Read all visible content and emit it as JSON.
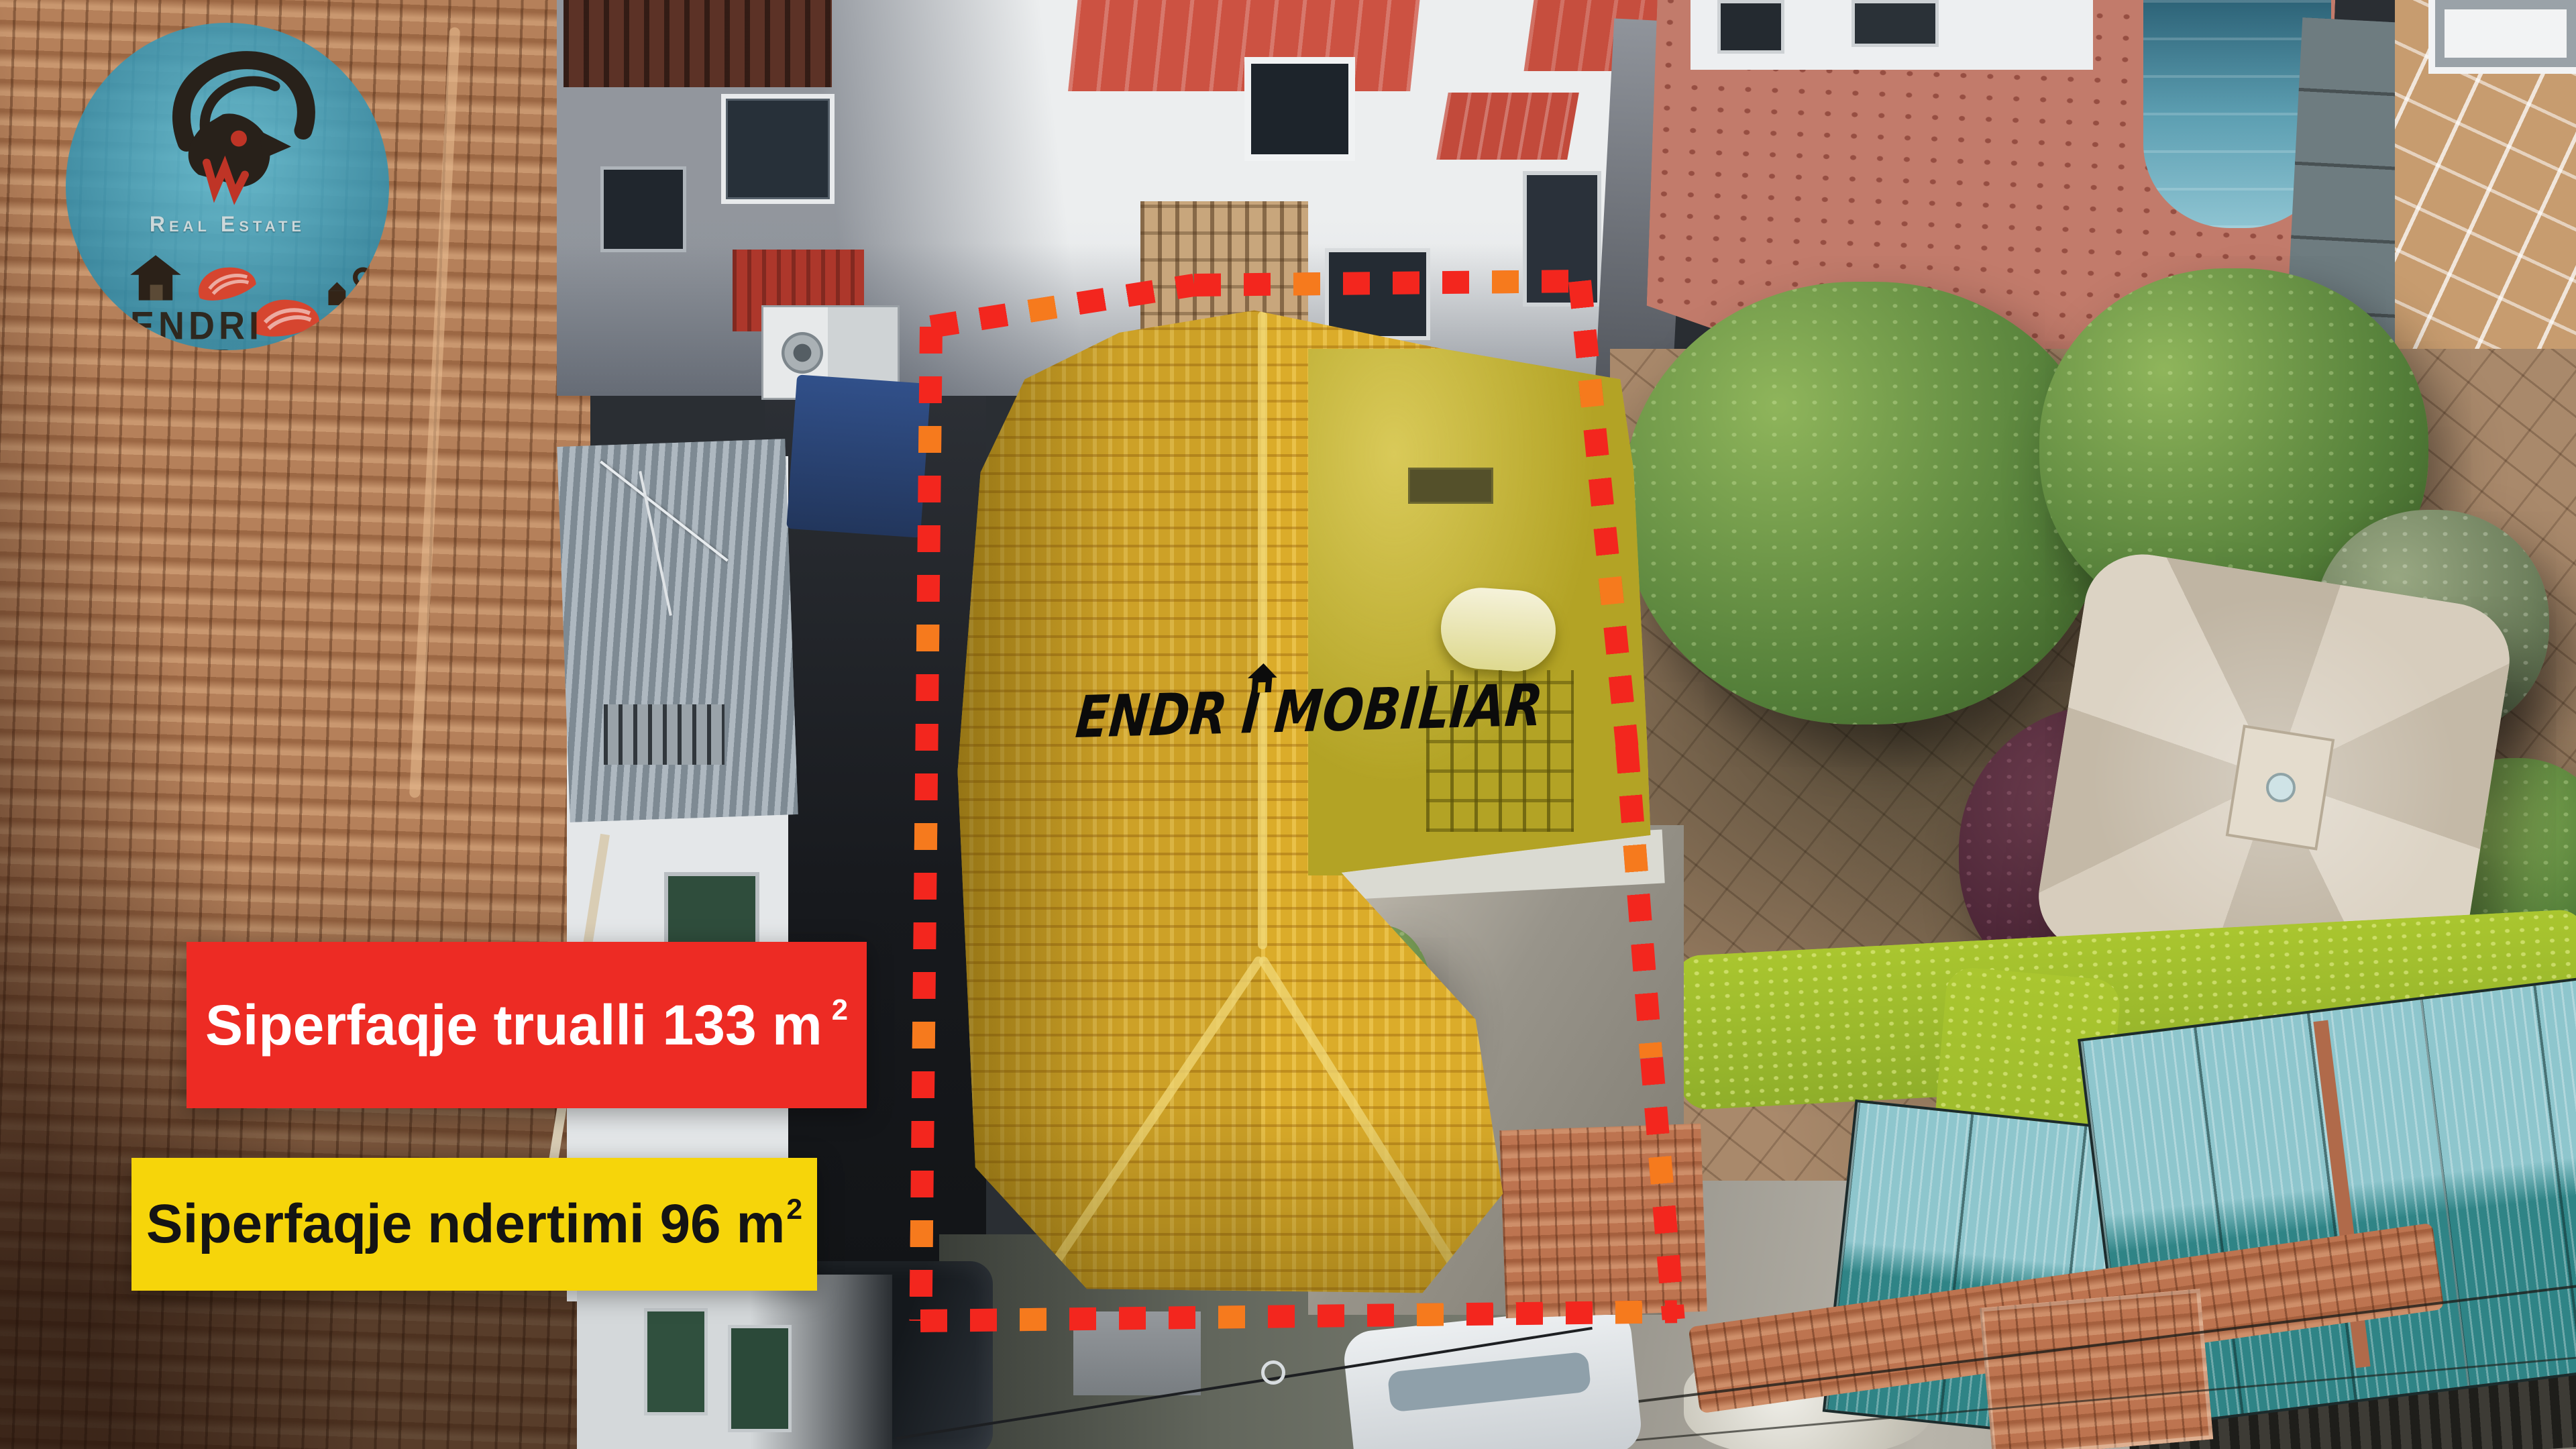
{
  "logo": {
    "tagline": "Real Estate",
    "name_line1": "ENDRI",
    "name_line2": "IMOBILIAR",
    "icons": {
      "mascot": "ibex-goat-silhouette",
      "house": "house-icon",
      "hands": "red-hands-icon",
      "keys": "keys-icon"
    }
  },
  "watermark": {
    "part1": "ENDR",
    "part2": "I",
    "part3": "MOBILIAR",
    "icon": "small-house-above-i"
  },
  "banners": {
    "land": {
      "label": "Siperfaqje trualli",
      "value": "133",
      "unit": "m",
      "superscript": "2"
    },
    "building": {
      "label": "Siperfaqje ndertimi",
      "value": "96",
      "unit": "m",
      "superscript": "2"
    }
  },
  "colors": {
    "boundary_red": "#f3261e",
    "boundary_orange": "#f57f1d",
    "highlight_yellow": "#cfa226",
    "banner_red_bg": "#ed2b24",
    "banner_red_fg": "#ffffff",
    "banner_yellow_bg": "#f6d50a",
    "banner_yellow_fg": "#141414",
    "logo_circle_teal": "#3a9ebc",
    "watermark_black": "#0b0b0b"
  }
}
